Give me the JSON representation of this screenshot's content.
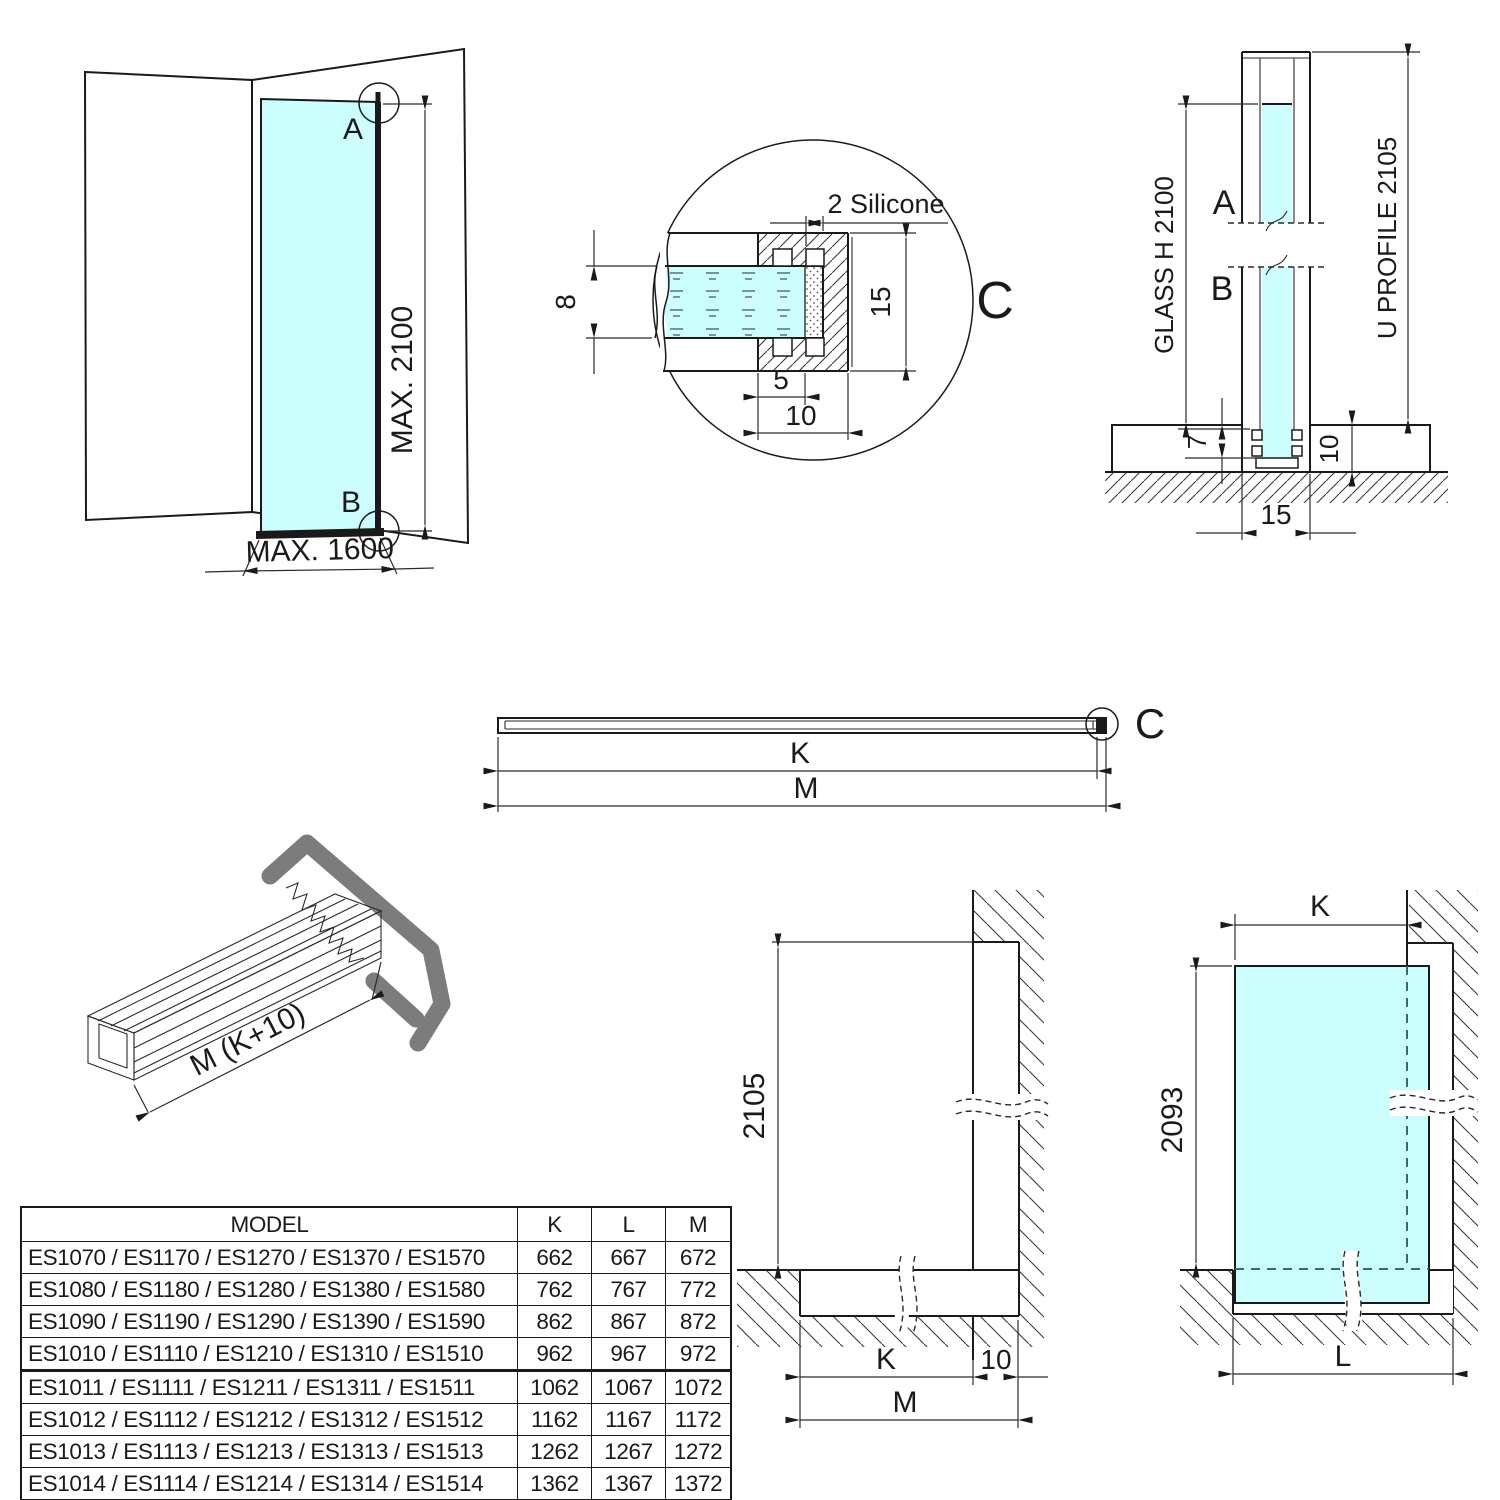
{
  "colors": {
    "glass": "#ccfefe",
    "line": "#1a1a1a",
    "gray_profile": "#7c7c7c",
    "hidden_edge": "#2e6e6e"
  },
  "views": {
    "corner": {
      "point_a": "A",
      "point_b": "B",
      "max_height": "MAX. 2100",
      "max_width": "MAX. 1600"
    },
    "detail": {
      "ref": "C",
      "silicone": "2 Silicone",
      "glass_thickness": "8",
      "profile_height": "15",
      "front_depth": "5",
      "total_depth": "10"
    },
    "section": {
      "point_a": "A",
      "point_b": "B",
      "glass_height": "GLASS H 2100",
      "profile_height": "U PROFILE 2105",
      "bottom_gap": "7",
      "base_height": "10",
      "profile_width": "15"
    },
    "bar": {
      "k": "K",
      "m": "M",
      "ref": "C"
    },
    "iso": {
      "length": "M (K+10)"
    },
    "elev_k": {
      "height": "2105",
      "k": "K",
      "offset": "10",
      "m": "M"
    },
    "elev_l": {
      "k": "K",
      "height": "2093",
      "l": "L"
    }
  },
  "table": {
    "headers": [
      "MODEL",
      "K",
      "L",
      "M"
    ],
    "rows": [
      {
        "model": "ES1070 / ES1170 / ES1270 / ES1370 / ES1570",
        "k": "662",
        "l": "667",
        "m": "672"
      },
      {
        "model": "ES1080 / ES1180 / ES1280 / ES1380 / ES1580",
        "k": "762",
        "l": "767",
        "m": "772"
      },
      {
        "model": "ES1090 / ES1190 / ES1290 / ES1390 / ES1590",
        "k": "862",
        "l": "867",
        "m": "872"
      },
      {
        "model": "ES1010 / ES1110 / ES1210 / ES1310 / ES1510",
        "k": "962",
        "l": "967",
        "m": "972"
      },
      {
        "model": "ES1011 / ES1111 / ES1211 / ES1311 / ES1511",
        "k": "1062",
        "l": "1067",
        "m": "1072"
      },
      {
        "model": "ES1012 / ES1112 / ES1212 / ES1312 / ES1512",
        "k": "1162",
        "l": "1167",
        "m": "1172"
      },
      {
        "model": "ES1013 / ES1113 / ES1213 / ES1313 / ES1513",
        "k": "1262",
        "l": "1267",
        "m": "1272"
      },
      {
        "model": "ES1014 / ES1114 / ES1214 / ES1314 / ES1514",
        "k": "1362",
        "l": "1367",
        "m": "1372"
      }
    ]
  }
}
